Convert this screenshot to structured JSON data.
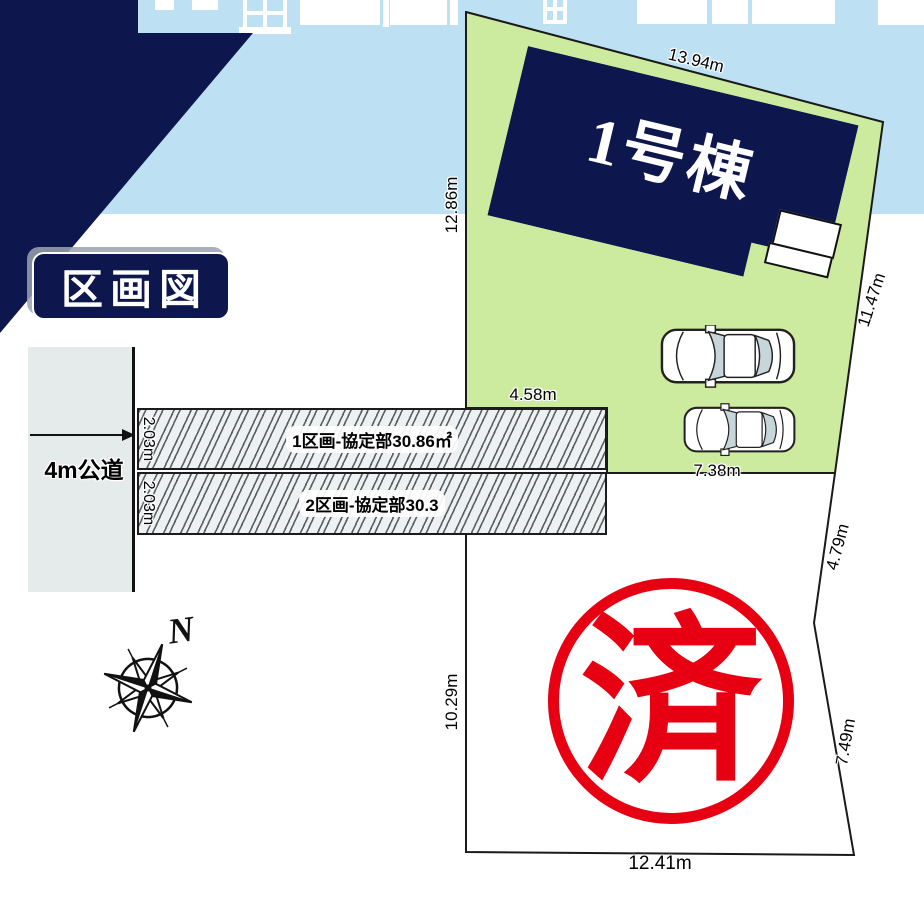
{
  "title": {
    "label": "区画図"
  },
  "plot1": {
    "building_label": "1号棟",
    "dim_top": "13.94m",
    "dim_left": "12.86m",
    "dim_right": "11.47m",
    "dim_inner_left": "4.58m",
    "dim_inner_bottom": "7.38m"
  },
  "plot2": {
    "dim_boundary_upper": "4.79m",
    "dim_left": "10.29m",
    "dim_right": "7.49m",
    "dim_bottom": "12.41m"
  },
  "strips": [
    {
      "label": "1区画-協定部30.86㎡",
      "width_label": "2.03m"
    },
    {
      "label": "2区画-協定部30.3",
      "width_label": "2.03m"
    }
  ],
  "road": {
    "label": "4m公道"
  },
  "compass": {
    "label": "N"
  },
  "stamp": {
    "label": "済"
  },
  "colors": {
    "navy": "#0d164d",
    "sky_blue": "#bde1f2",
    "plot_green": "#cdeb9e",
    "road_gray": "#e5eaeb",
    "stamp_red": "#e60012"
  }
}
